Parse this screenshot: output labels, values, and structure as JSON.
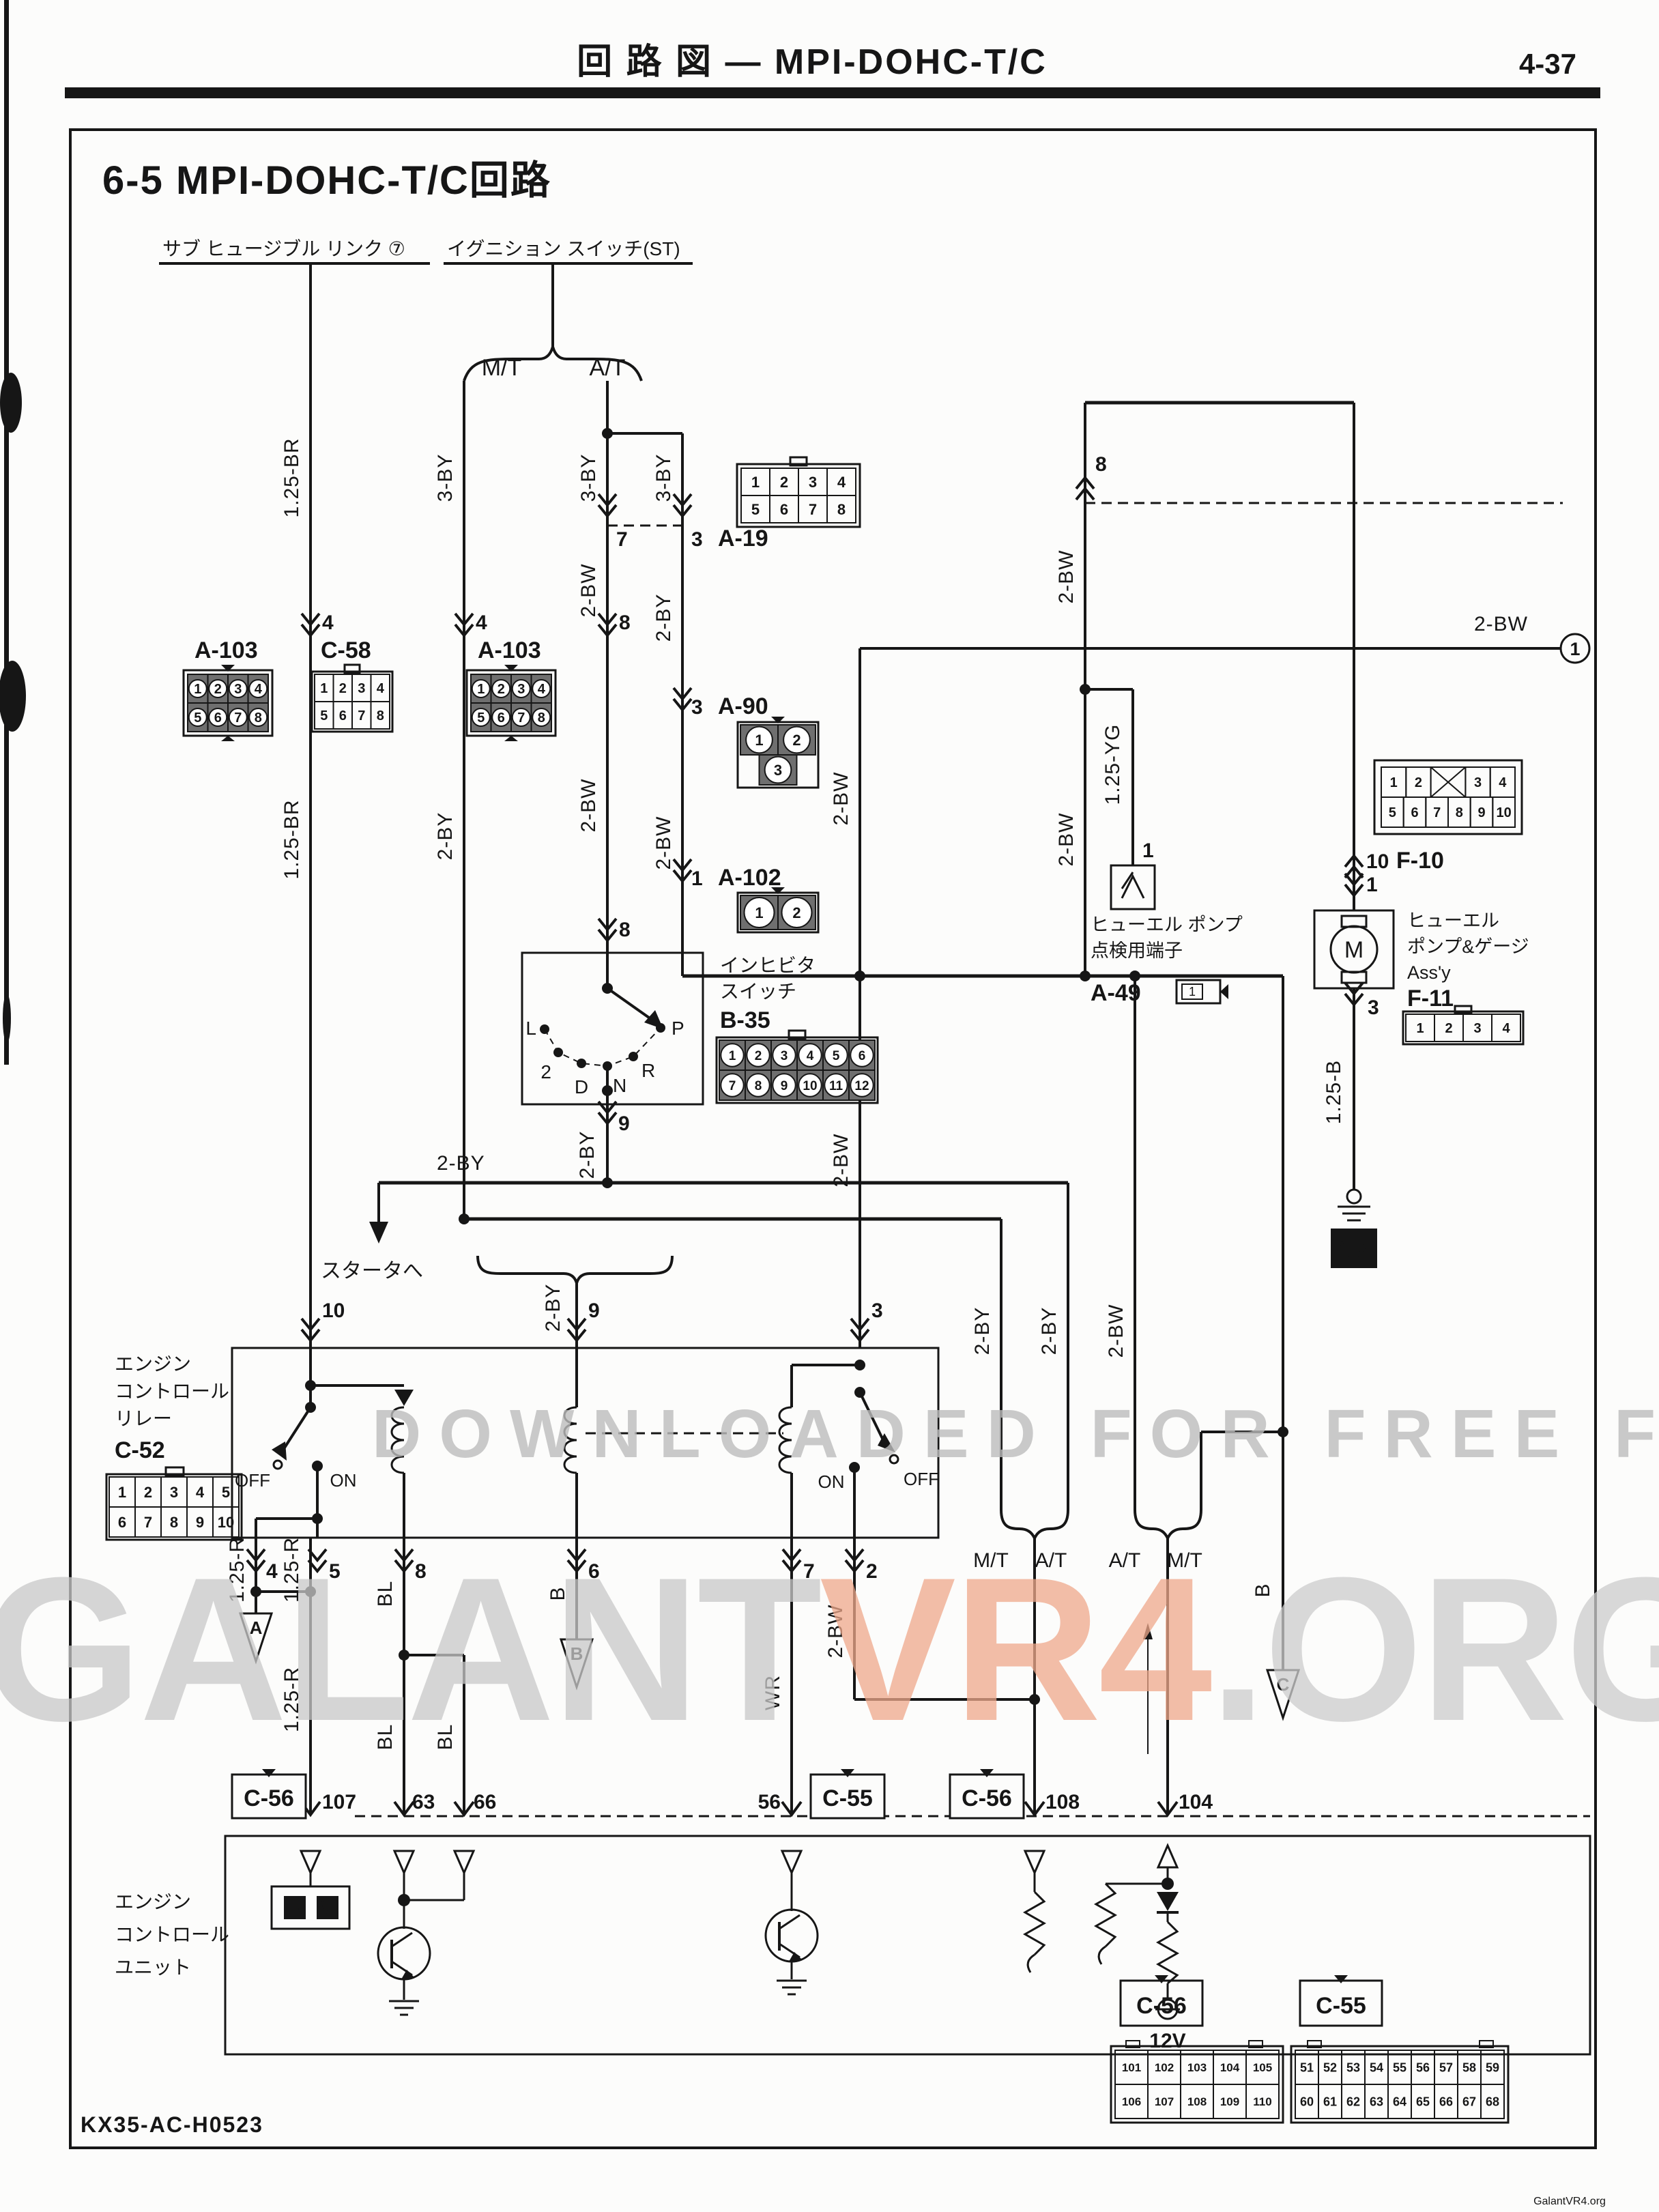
{
  "header": {
    "title": "回 路 図 — MPI-DOHC-T/C",
    "page": "4-37"
  },
  "title": "6-5 MPI-DOHC-T/C回路",
  "footer": {
    "code": "KX35-AC-H0523",
    "credit": "GalantVR4.org"
  },
  "watermark": {
    "line1": "DOWNLOADED FOR FREE FROM:",
    "g1": "GALANT",
    "accent": "VR4",
    "g2": ".ORG"
  },
  "sources": {
    "sub_link": "サブ ヒュージブル リンク ⑦",
    "ignition": "イグニション スイッチ(ST)"
  },
  "trans": {
    "mt": "M/T",
    "at": "A/T"
  },
  "wires": {
    "w125br": "1.25-BR",
    "w3by": "3-BY",
    "w2by": "2-BY",
    "w2bw": "2-BW",
    "w125yg": "1.25-YG",
    "w125b": "1.25-B",
    "w125r": "1.25-R",
    "wbl": "BL",
    "wb": "B",
    "wwr": "WR"
  },
  "pins": {
    "n1": "1",
    "n2": "2",
    "n3": "3",
    "n4": "4",
    "n5": "5",
    "n6": "6",
    "n7": "7",
    "n8": "8",
    "n9": "9",
    "n10": "10",
    "n56": "56",
    "n63": "63",
    "n66": "66",
    "n104": "104",
    "n107": "107",
    "n108": "108"
  },
  "refs": {
    "a": "A",
    "b": "B",
    "c": "C",
    "page": "1",
    "ground": "17",
    "volt": "12V"
  },
  "sw": {
    "on": "ON",
    "off": "OFF"
  },
  "gear": {
    "l": "L",
    "two": "2",
    "d": "D",
    "n": "N",
    "r": "R",
    "p": "P"
  },
  "labels": {
    "to_starter": "スタータへ",
    "relay": [
      "エンジン",
      "コントロール",
      "リレー"
    ],
    "inhibitor": [
      "インヒビタ",
      "スイッチ"
    ],
    "check1": "ヒューエル ポンプ",
    "check2": "点検用端子",
    "check_name": "A-49",
    "pump": [
      "ヒューエル",
      "ポンプ&ゲージ",
      "Ass'y"
    ],
    "ecu": [
      "エンジン",
      "コントロール",
      "ユニット"
    ],
    "power_l": "電",
    "power_r": "源"
  },
  "connectors": {
    "a19": {
      "name": "A-19",
      "pins_top": [
        "1",
        "2",
        "3",
        "4"
      ],
      "pins_bottom": [
        "5",
        "6",
        "7",
        "8"
      ]
    },
    "a90": {
      "name": "A-90",
      "pins_top": [
        "1",
        "2"
      ],
      "pins_bottom": [
        "3"
      ]
    },
    "a102": {
      "name": "A-102",
      "pins": [
        "1",
        "2"
      ]
    },
    "a103": {
      "name": "A-103",
      "pins_top": [
        "1",
        "2",
        "3",
        "4"
      ],
      "pins_bottom": [
        "5",
        "6",
        "7",
        "8"
      ]
    },
    "c58": {
      "name": "C-58",
      "pins_top": [
        "1",
        "2",
        "3",
        "4"
      ],
      "pins_bottom": [
        "5",
        "6",
        "7",
        "8"
      ]
    },
    "c52": {
      "name": "C-52",
      "pins_top": [
        "1",
        "2",
        "3",
        "4",
        "5"
      ],
      "pins_bottom": [
        "6",
        "7",
        "8",
        "9",
        "10"
      ]
    },
    "b35": {
      "name": "B-35",
      "pins_top": [
        "1",
        "2",
        "3",
        "4",
        "5",
        "6"
      ],
      "pins_bottom": [
        "7",
        "8",
        "9",
        "10",
        "11",
        "12"
      ]
    },
    "f10": {
      "name": "F-10",
      "pins_top": [
        "1",
        "2",
        "3",
        "4"
      ],
      "pins_bottom": [
        "5",
        "6",
        "7",
        "8",
        "9",
        "10"
      ]
    },
    "f11": {
      "name": "F-11",
      "pins": [
        "1",
        "2",
        "3",
        "4"
      ]
    },
    "c56": {
      "name": "C-56",
      "pins_top": [
        "101",
        "102",
        "103",
        "104",
        "105"
      ],
      "pins_bottom": [
        "106",
        "107",
        "108",
        "109",
        "110"
      ]
    },
    "c55": {
      "name": "C-55",
      "pins_top": [
        "51",
        "52",
        "53",
        "54",
        "55",
        "56",
        "57",
        "58",
        "59"
      ],
      "pins_bottom": [
        "60",
        "61",
        "62",
        "63",
        "64",
        "65",
        "66",
        "67",
        "68"
      ]
    }
  }
}
